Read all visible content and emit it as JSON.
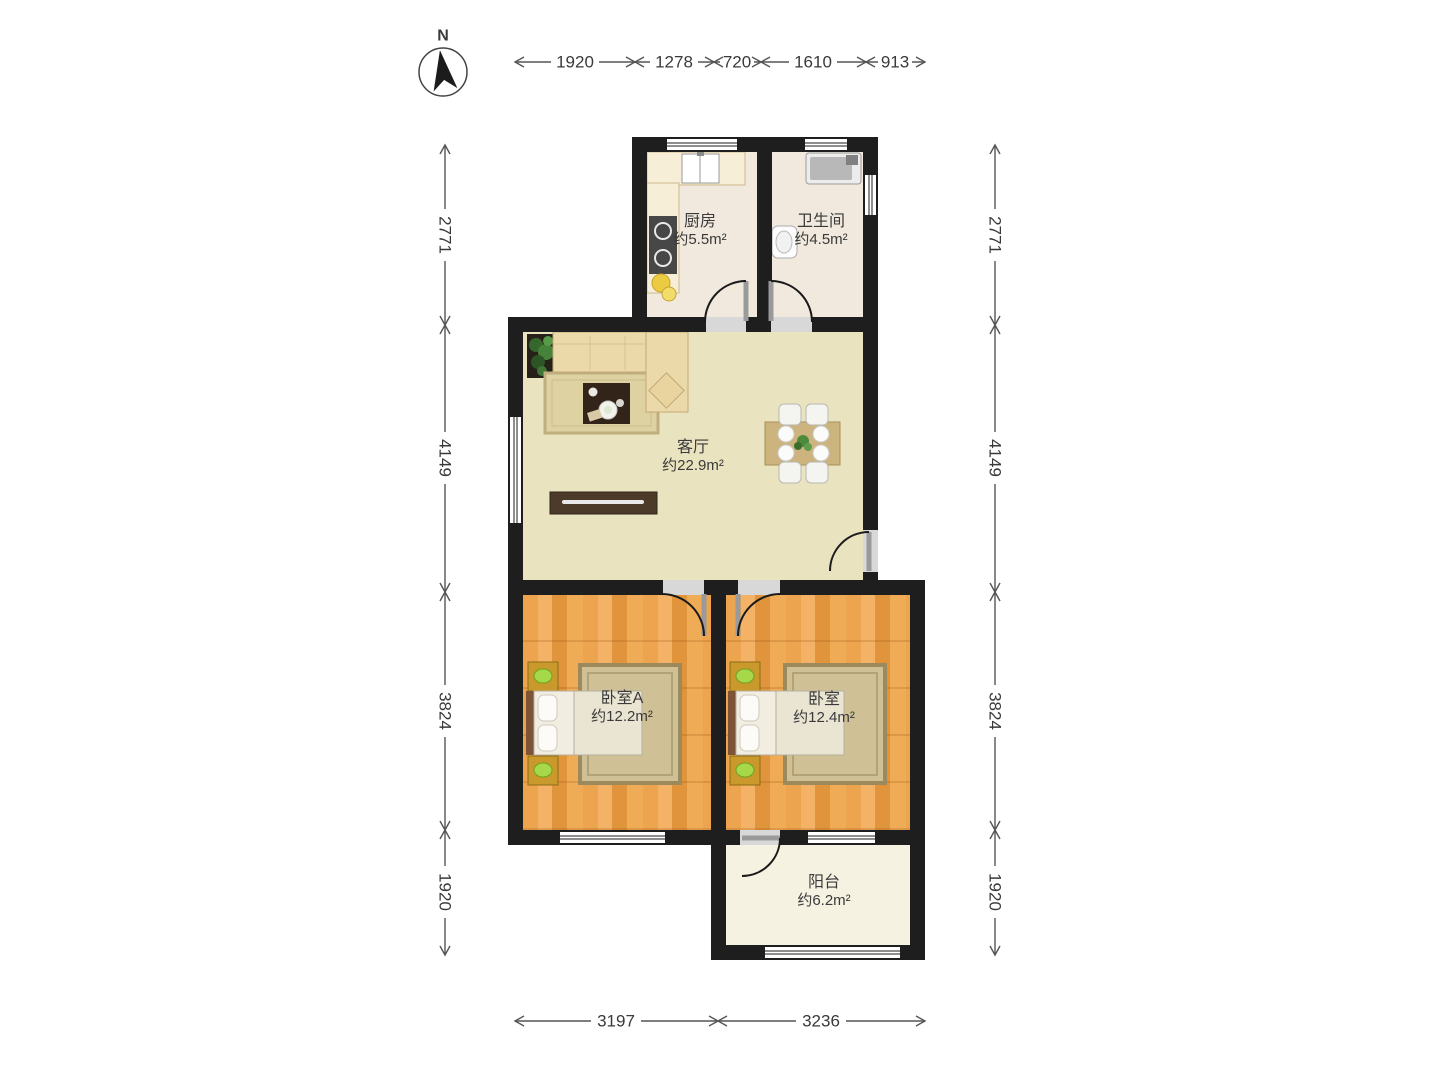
{
  "compass": {
    "north_label": "N"
  },
  "rooms": {
    "kitchen": {
      "name": "厨房",
      "area": "约5.5m²"
    },
    "bathroom": {
      "name": "卫生间",
      "area": "约4.5m²"
    },
    "living_room": {
      "name": "客厅",
      "area": "约22.9m²"
    },
    "bedroom_a": {
      "name": "卧室A",
      "area": "约12.2m²"
    },
    "bedroom_b": {
      "name": "卧室",
      "area": "约12.4m²"
    },
    "balcony": {
      "name": "阳台",
      "area": "约6.2m²"
    }
  },
  "dimensions_mm": {
    "top": [
      "1920",
      "1278",
      "720",
      "1610",
      "913"
    ],
    "left": [
      "2771",
      "4149",
      "3824",
      "1920"
    ],
    "right": [
      "2771",
      "4149",
      "3824",
      "1920"
    ],
    "bottom": [
      "3197",
      "3236"
    ]
  },
  "palette": {
    "wall": "#1e1e1e",
    "wood_floor": "#eda44e",
    "tile_floor": "#f1e9dd",
    "living_floor": "#eae3bf",
    "balcony_floor": "#f6f2e2",
    "dimension_text": "#3a3a3a"
  }
}
